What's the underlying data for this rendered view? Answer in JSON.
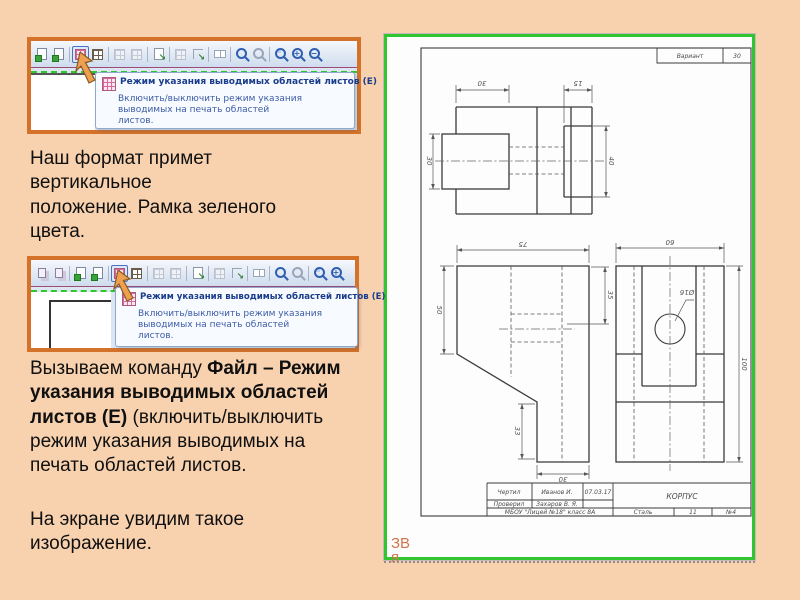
{
  "colors": {
    "slide_bg": "#f8d2af",
    "shot_border": "#d4722a",
    "frame_green": "#2fc62f",
    "tooltip_title": "#1a3c8c",
    "note_orange": "#d2744b"
  },
  "screenshot1": {
    "tooltip": {
      "title": "Режим указания выводимых областей листов (E)",
      "body": "Включить/выключить режим указания\nвыводимых на печать областей\nлистов."
    },
    "icons": [
      {
        "kind": "page",
        "name": "new-sheet-icon"
      },
      {
        "kind": "page",
        "name": "add-sheet-icon"
      },
      {
        "kind": "sep"
      },
      {
        "kind": "target",
        "name": "print-area-mode-button"
      },
      {
        "kind": "grid",
        "name": "fit-scale-icon"
      },
      {
        "kind": "sep"
      },
      {
        "kind": "griddis",
        "name": "layout-icon"
      },
      {
        "kind": "griddis",
        "name": "layout-2-icon"
      },
      {
        "kind": "sep"
      },
      {
        "kind": "go",
        "name": "select-part-icon"
      },
      {
        "kind": "sep"
      },
      {
        "kind": "griddis",
        "name": "grid-settings-icon"
      },
      {
        "kind": "corner",
        "name": "move-area-icon"
      },
      {
        "kind": "sep"
      },
      {
        "kind": "pair",
        "name": "pages-layout-icon"
      },
      {
        "kind": "sep"
      },
      {
        "kind": "zoom",
        "name": "zoom-tool-icon"
      },
      {
        "kind": "zoomdis",
        "name": "zoom-pan-icon"
      },
      {
        "kind": "sep"
      },
      {
        "kind": "zoomrect",
        "name": "zoom-rect-icon"
      },
      {
        "kind": "zoomin",
        "name": "zoom-plus-icon"
      },
      {
        "kind": "zoomout",
        "name": "zoom-minus-icon"
      }
    ]
  },
  "screenshot2": {
    "tooltip": {
      "title": "Режим указания выводимых областей листов (E)",
      "body": "Включить/выключить режим указания\nвыводимых на печать областей\nлистов."
    },
    "icons": [
      {
        "kind": "pages",
        "name": "copy-sheet-icon"
      },
      {
        "kind": "pages",
        "name": "copy-sheet-2-icon"
      },
      {
        "kind": "sep"
      },
      {
        "kind": "page",
        "name": "new-sheet-icon"
      },
      {
        "kind": "page",
        "name": "add-sheet-icon"
      },
      {
        "kind": "sep"
      },
      {
        "kind": "target",
        "name": "print-area-mode-button"
      },
      {
        "kind": "grid",
        "name": "fit-scale-icon"
      },
      {
        "kind": "sep"
      },
      {
        "kind": "griddis",
        "name": "layout-icon"
      },
      {
        "kind": "griddis",
        "name": "layout-2-icon"
      },
      {
        "kind": "sep"
      },
      {
        "kind": "go",
        "name": "select-part-icon"
      },
      {
        "kind": "sep"
      },
      {
        "kind": "griddis",
        "name": "grid-settings-icon"
      },
      {
        "kind": "corner",
        "name": "move-area-icon"
      },
      {
        "kind": "sep"
      },
      {
        "kind": "pair",
        "name": "pages-layout-icon"
      },
      {
        "kind": "sep"
      },
      {
        "kind": "zoom",
        "name": "zoom-tool-icon"
      },
      {
        "kind": "zoomdis",
        "name": "zoom-pan-icon"
      },
      {
        "kind": "sep"
      },
      {
        "kind": "zoomrect",
        "name": "zoom-rect-icon"
      },
      {
        "kind": "zoomin",
        "name": "zoom-plus-icon"
      }
    ]
  },
  "instruction1": {
    "text": "Наш формат примет\nвертикальное\nположение. Рамка зеленого\nцвета."
  },
  "instruction2": {
    "parts": [
      {
        "text": "Вызываем команду  ",
        "bold": false
      },
      {
        "text": "Файл – Режим\nуказания выводимых областей\nлистов (Е) ",
        "bold": true
      },
      {
        "text": "(включить/выключить\nрежим указания выводимых на\nпечать областей листов.",
        "bold": false
      }
    ]
  },
  "instruction3": {
    "text": "На экране увидим такое\nизображение."
  },
  "drawing": {
    "variant": {
      "label": "Вариант",
      "value": "30"
    },
    "title_block": {
      "drew_label": "Чертил",
      "drew_name": "Иванов И.",
      "date": "07.03.17",
      "checked_label": "Проверил",
      "checked_name": "Захаров В. Я.",
      "part_name": "КОРПУС",
      "school": "МБОУ \"Лицей №18\" класс 8А",
      "material": "Сталь",
      "scale": "11",
      "sheet_no": "№4"
    },
    "dims": {
      "front_w": "30",
      "front_w2": "15",
      "front_hl": "30",
      "front_hr": "40",
      "left_w": "75",
      "left_h": "50",
      "left_r": "35",
      "left_s": "33",
      "left_b": "30",
      "right_w": "60",
      "right_h": "100",
      "hole": "Ø16"
    },
    "corner_note": "ЗВ\nя"
  }
}
